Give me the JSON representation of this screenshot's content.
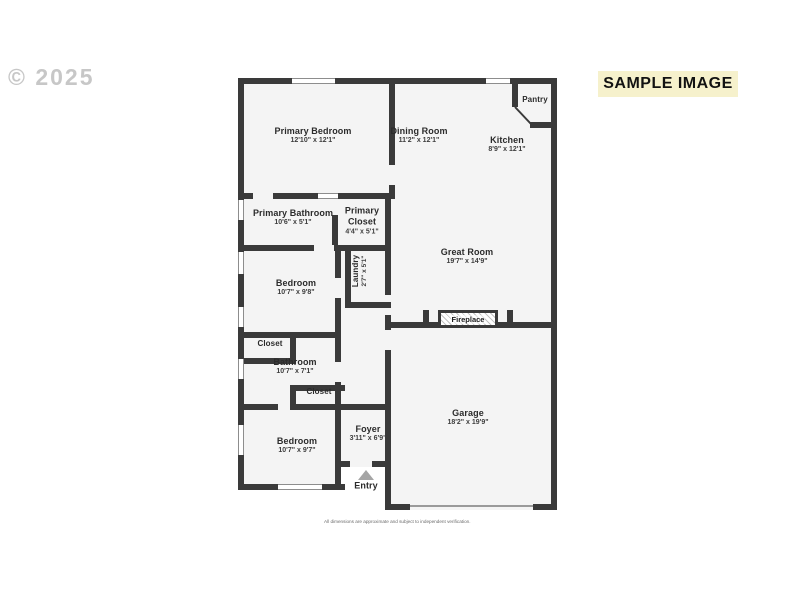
{
  "watermark": "© 2025",
  "banner": "SAMPLE IMAGE",
  "rooms": {
    "primary_bedroom": {
      "name": "Primary Bedroom",
      "dims": "12'10\" x 12'1\""
    },
    "dining_room": {
      "name": "Dining Room",
      "dims": "11'2\" x 12'1\""
    },
    "kitchen": {
      "name": "Kitchen",
      "dims": "8'9\" x 12'1\""
    },
    "pantry": {
      "name": "Pantry"
    },
    "primary_bathroom": {
      "name": "Primary Bathroom",
      "dims": "10'6\" x 5'1\""
    },
    "primary_closet": {
      "name": "Primary Closet",
      "dims": "4'4\" x 5'1\""
    },
    "laundry": {
      "name": "Laundry",
      "dims": "2'7\" x 5'1\""
    },
    "great_room": {
      "name": "Great Room",
      "dims": "19'7\" x 14'9\""
    },
    "bedroom_2": {
      "name": "Bedroom",
      "dims": "10'7\" x 9'8\""
    },
    "closet_1": {
      "name": "Closet"
    },
    "bathroom": {
      "name": "Bathroom",
      "dims": "10'7\" x 7'1\""
    },
    "closet_2": {
      "name": "Closet"
    },
    "bedroom_3": {
      "name": "Bedroom",
      "dims": "10'7\" x 9'7\""
    },
    "foyer": {
      "name": "Foyer",
      "dims": "3'11\" x 6'9\""
    },
    "entry": {
      "name": "Entry"
    },
    "garage": {
      "name": "Garage",
      "dims": "18'2\" x 19'9\""
    },
    "fireplace": {
      "name": "Fireplace"
    }
  },
  "disclaimer": "All dimensions are approximate and subject to independent verification.",
  "colors": {
    "wall": "#3a3a3a",
    "room_fill": "#f4f4f4",
    "banner_bg": "#f6f1cc",
    "watermark": "#c7c7c7",
    "entry_arrow": "#a5a5a5"
  }
}
